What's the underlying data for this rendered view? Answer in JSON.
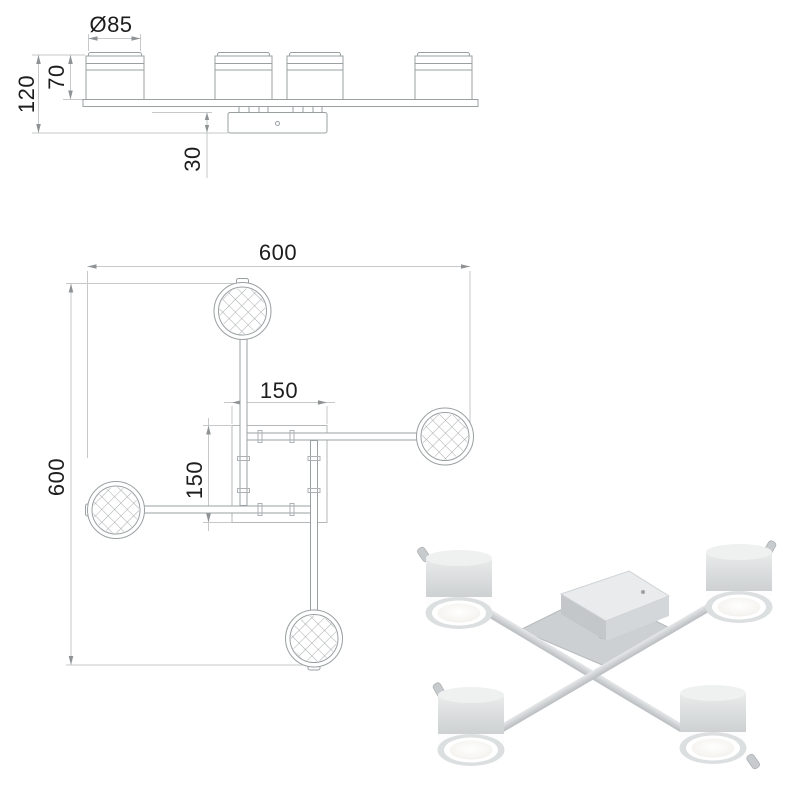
{
  "technical_drawing": {
    "side_view": {
      "view_name": "side-elevation",
      "dims": {
        "diameter": "Ø85",
        "head_height": "70",
        "total_height": "120",
        "canopy_height": "30"
      }
    },
    "plan_view": {
      "view_name": "top-plan",
      "dims": {
        "overall_width": "600",
        "overall_height": "600",
        "canopy_width": "150",
        "canopy_depth": "150"
      }
    },
    "colors": {
      "object_line": "#9aa0a2",
      "square_line": "#b5b8ba",
      "dimension_line": "#c2c4c6",
      "arrow_fill": "#8e9294",
      "dimension_text": "#1d1d1d",
      "hatch_line": "#a8acae"
    }
  },
  "product_photo": {
    "spot_count": 4,
    "colors": {
      "metal_light": "#e9ebec",
      "metal_mid": "#d2d5d6",
      "metal_dark": "#b4b8ba",
      "glow_white": "#fdfdfd",
      "lens_white": "#f5f4f0"
    }
  }
}
